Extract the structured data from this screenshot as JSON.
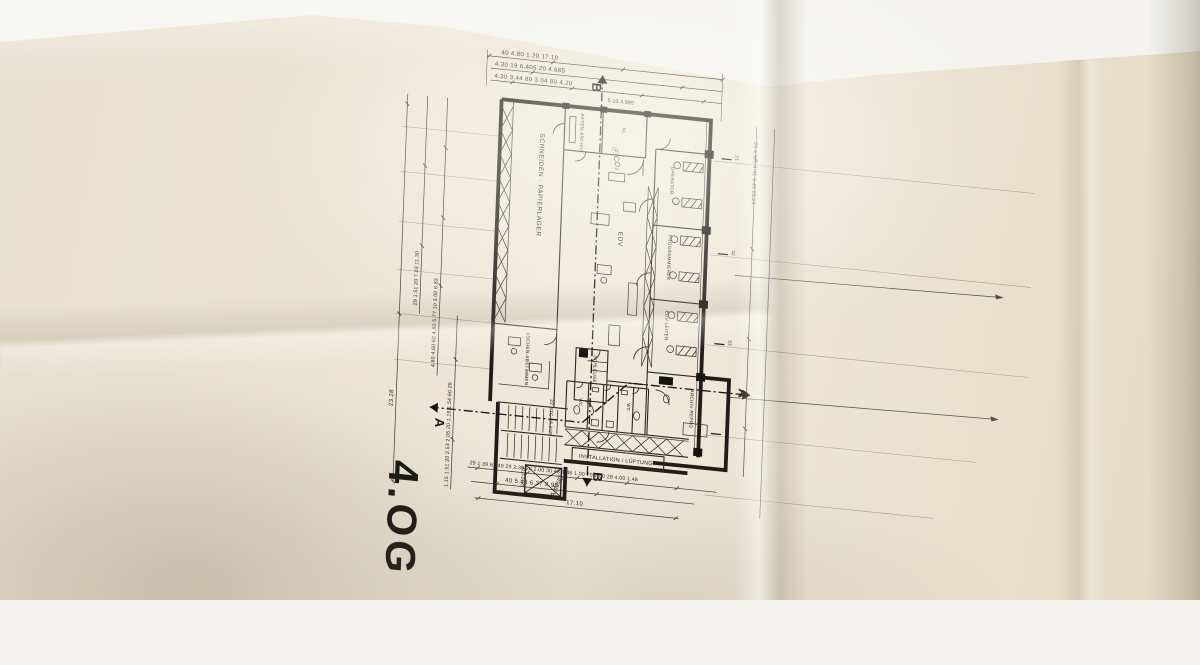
{
  "sheet": {
    "floor_label": "4.OG",
    "colors": {
      "paper": "#ebe4d3",
      "ink": "#23211c",
      "pencil": "#7d7666"
    },
    "rooms": {
      "schneiden": "SCHNEIDEN · PAPIERLAGER",
      "akten_archiv": "AKTEN-ARCHIV",
      "kl": "KL.",
      "edv": "EDV",
      "operator": "OPERATOR",
      "programmierer": "PROGRAMMIERER",
      "edv_leiter": "EDV-LEITER",
      "lochen": "LOCHEN-ABSTIMMEN",
      "schleuse": "SCHLEUSE",
      "wc_left": "WC",
      "wc_right": "WC",
      "archiv_repro": "ARCHIV·REPRO",
      "installation": "INSTALLATION / LÜFTUNG",
      "aufzug": "AUFZUG",
      "stair_note": "22 STG 16,2/26"
    },
    "annotations": {
      "co2_note": "Ⓕ CO₂",
      "handwritten_note": "Aufzug"
    },
    "section_markers": {
      "a": "A",
      "b": "B"
    },
    "grid_labels": [
      "31",
      "32",
      "33",
      "34"
    ],
    "dims": {
      "top1": [
        "40",
        "4.80",
        "1.20",
        "17.10"
      ],
      "top2": [
        "4.30",
        "19",
        "6.405",
        "20",
        "4.685"
      ],
      "top3": [
        "4.30",
        "3.44",
        "80",
        "3.04",
        "80",
        "4.20"
      ],
      "top4": [
        "5.10",
        "4.985"
      ],
      "left_outer": "23.28",
      "left_mid": [
        "29",
        "1.51",
        "20",
        "7.03",
        "11.30"
      ],
      "left_inner": [
        "4.60",
        "4.60",
        "62",
        "4.60",
        "5.77",
        "10",
        "3.00",
        "6.83"
      ],
      "left_lower": [
        "1.15",
        "1.51",
        "20",
        "2.53",
        "2.05",
        "20",
        "1.15",
        "1.54",
        "60",
        "29"
      ],
      "right_chain": [
        "28",
        "4.985",
        "4.41",
        "4.43",
        "23.28"
      ],
      "bottom1": [
        "29",
        "1.39",
        "61",
        "40",
        "29",
        "2.30",
        "20",
        "2.00",
        "30",
        "48",
        "1.46",
        "1.00",
        "70",
        "1.00",
        "28",
        "4.00",
        "1.48"
      ],
      "bottom2": [
        "40",
        "5.48",
        "6.37",
        "2.99"
      ],
      "bottom3": "17.10"
    }
  }
}
